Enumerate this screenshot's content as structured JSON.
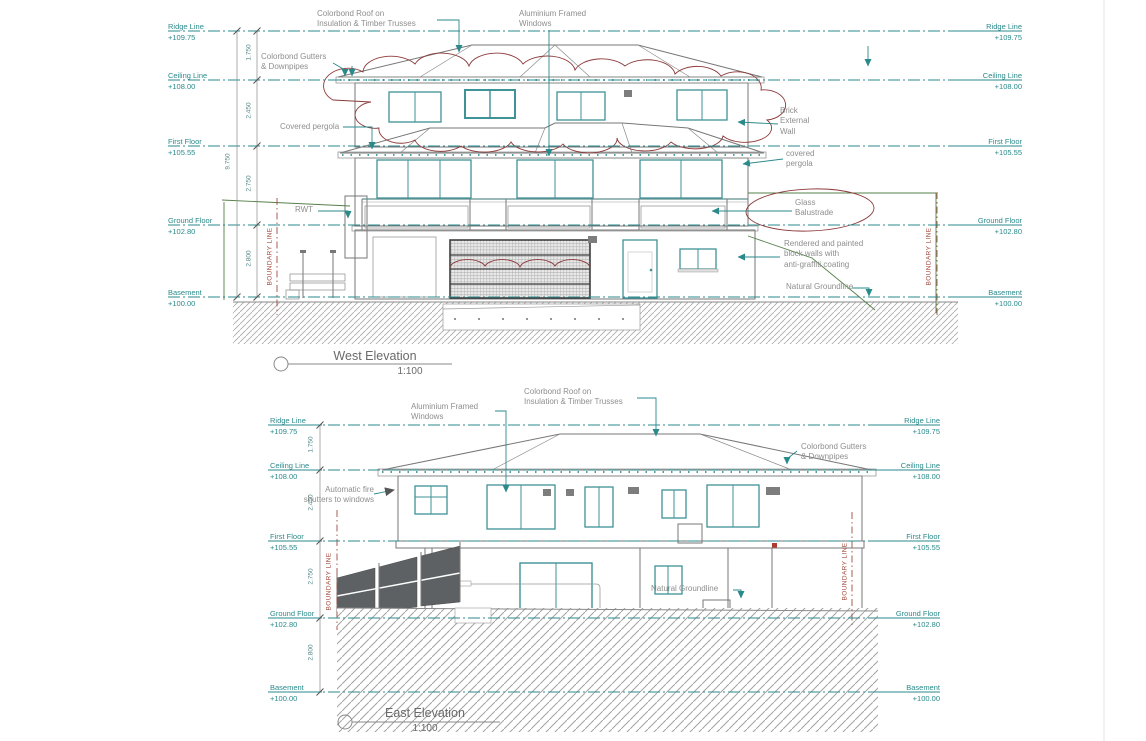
{
  "west": {
    "title": "West Elevation",
    "scale": "1:100",
    "levels": [
      {
        "name": "Ridge Line",
        "value": "+109.75"
      },
      {
        "name": "Ceiling Line",
        "value": "+108.00"
      },
      {
        "name": "First Floor",
        "value": "+105.55"
      },
      {
        "name": "Ground Floor",
        "value": "+102.80"
      },
      {
        "name": "Basement",
        "value": "+100.00"
      }
    ],
    "dim_overall": "9.750",
    "dims": [
      "1.750",
      "2.450",
      "2.750",
      "2.800"
    ],
    "boundary_label": "BOUNDARY LINE",
    "notes": {
      "roof": "Colorbond Roof on\nInsulation & Timber Trusses",
      "windows": "Aluminium Framed\nWindows",
      "gutters": "Colorbond Gutters\n& Downpipes",
      "pergola_left": "Covered pergola",
      "rwt": "RWT",
      "brick": "Brick\nExternal\nWall",
      "pergola_right": "covered\npergola",
      "balustrade": "Glass\nBalustrade",
      "rendered_walls": "Rendered and painted\nblock walls with\nanti-graffiti coating",
      "groundline": "Natural Groundline"
    }
  },
  "east": {
    "title": "East Elevation",
    "scale": "1:100",
    "levels": [
      {
        "name": "Ridge Line",
        "value": "+109.75"
      },
      {
        "name": "Ceiling Line",
        "value": "+108.00"
      },
      {
        "name": "First Floor",
        "value": "+105.55"
      },
      {
        "name": "Ground Floor",
        "value": "+102.80"
      },
      {
        "name": "Basement",
        "value": "+100.00"
      }
    ],
    "dims": [
      "1.750",
      "2.450",
      "2.750",
      "2.800"
    ],
    "boundary_label": "BOUNDARY LINE",
    "notes": {
      "roof": "Colorbond Roof on\nInsulation & Timber Trusses",
      "windows": "Aluminium Framed\nWindows",
      "fire_shutters": "Automatic fire\nshutters to windows",
      "gutters": "Colorbond Gutters\n& Downpipes",
      "groundline": "Natural Groundline"
    }
  },
  "colors": {
    "level_line": "#2a8a8b",
    "annotation": "#8e8e8e",
    "revision_cloud": "#8d3a3a",
    "boundary": "#a34b3e",
    "natural_ground": "#55804a"
  }
}
